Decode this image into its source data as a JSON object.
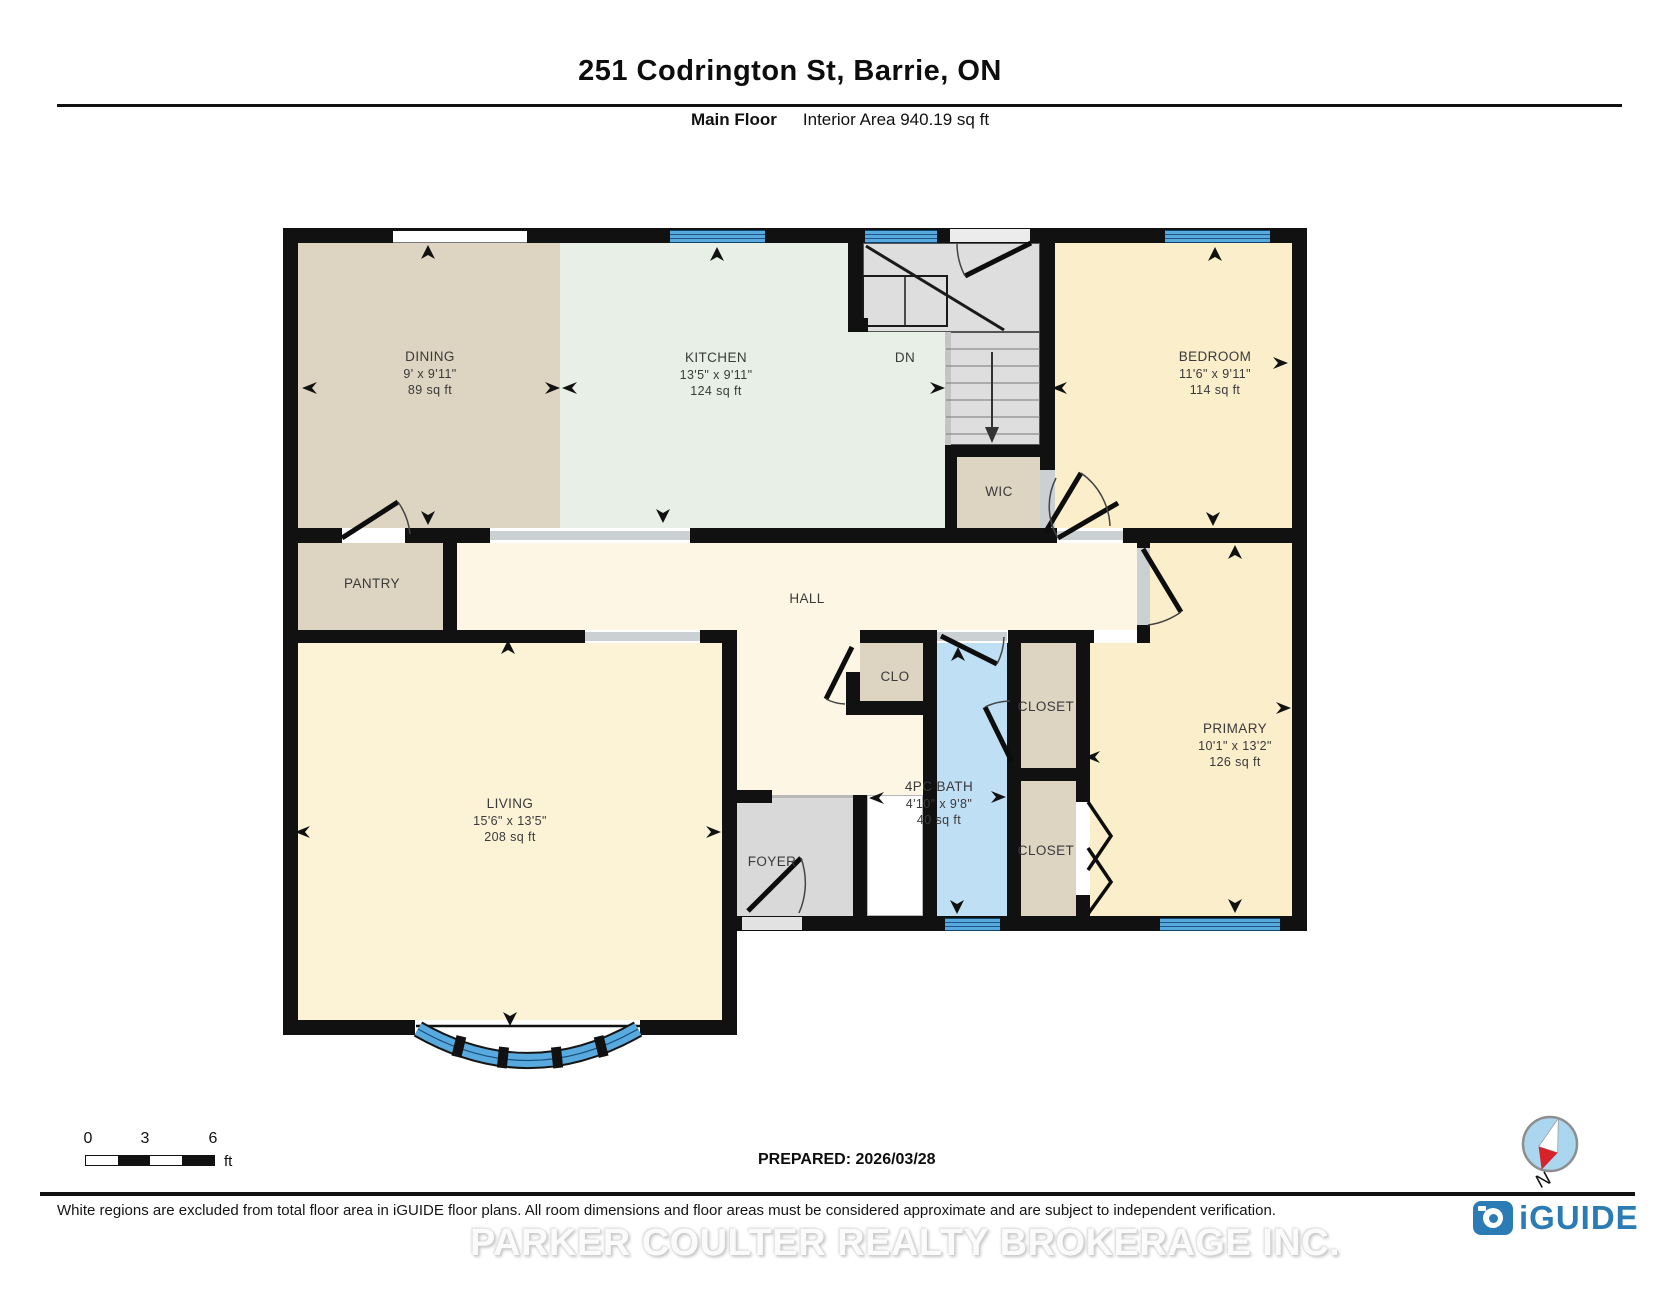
{
  "header": {
    "title": "251 Codrington St, Barrie, ON",
    "floor_label": "Main Floor",
    "area_label": "Interior Area 940.19 sq ft"
  },
  "rooms": {
    "dining": {
      "name": "DINING",
      "dim": "9' x 9'11\"",
      "area": "89 sq ft"
    },
    "kitchen": {
      "name": "KITCHEN",
      "dim": "13'5\" x 9'11\"",
      "area": "124 sq ft"
    },
    "bedroom": {
      "name": "BEDROOM",
      "dim": "11'6\" x 9'11\"",
      "area": "114 sq ft"
    },
    "living": {
      "name": "LIVING",
      "dim": "15'6\" x 13'5\"",
      "area": "208 sq ft"
    },
    "primary": {
      "name": "PRIMARY",
      "dim": "10'1\" x 13'2\"",
      "area": "126 sq ft"
    },
    "bath": {
      "name": "4PC BATH",
      "dim": "4'10\" x 9'8\"",
      "area": "40 sq ft"
    },
    "wic": {
      "name": "WIC"
    },
    "pantry": {
      "name": "PANTRY"
    },
    "hall": {
      "name": "HALL"
    },
    "clo": {
      "name": "CLO"
    },
    "closet_top": {
      "name": "CLOSET"
    },
    "closet_bottom": {
      "name": "CLOSET"
    },
    "foyer": {
      "name": "FOYER"
    },
    "stairs": {
      "name": "DN"
    }
  },
  "scale_bar": {
    "ticks": [
      "0",
      "3",
      "6"
    ],
    "unit": "ft"
  },
  "prepared_label": "PREPARED: 2026/03/28",
  "compass": {
    "label": "N"
  },
  "footer": {
    "disclaimer": "White regions are excluded from total floor area in iGUIDE floor plans. All room dimensions and floor areas must be considered approximate and are subject to independent verification.",
    "watermark": "PARKER COULTER REALTY BROKERAGE INC.",
    "brand": "iGUIDE"
  },
  "colors": {
    "wall": "#111111",
    "window_blue": "#58a9dd",
    "bath_blue": "#bedff4",
    "beige": "#ddd4c2",
    "mint": "#e7efe6",
    "cream": "#fdf6e4",
    "yellow": "#faeecb",
    "living_yellow": "#fcf2d6",
    "stair_gray": "#dedede",
    "brand_blue": "#2b7cb5",
    "compass_red": "#d6232a"
  }
}
